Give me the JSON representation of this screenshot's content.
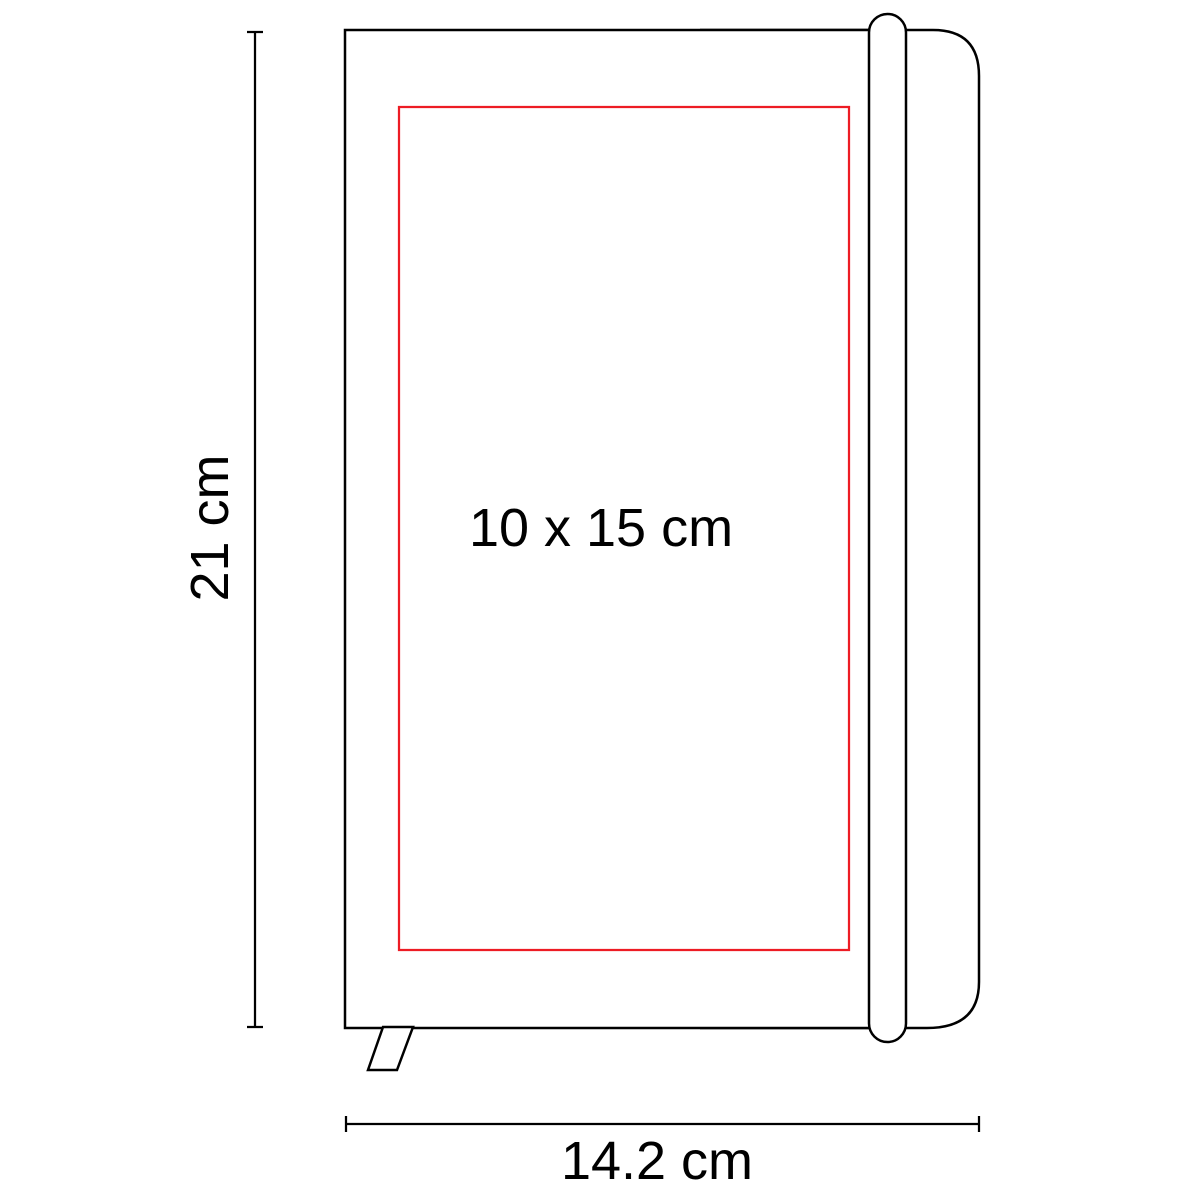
{
  "diagram": {
    "type": "product-dimension-drawing",
    "subject": "closed notebook with elastic band and bookmark ribbon, front view",
    "labels": {
      "height": "21 cm",
      "width": "14.2 cm",
      "print_area": "10 x 15 cm"
    },
    "dimensions": {
      "height_cm": 21,
      "width_cm": 14.2,
      "print_area_width_cm": 10,
      "print_area_height_cm": 15
    }
  },
  "colors": {
    "line": "#000000",
    "print_area": "#ED1C24",
    "background": "#FFFFFF"
  }
}
